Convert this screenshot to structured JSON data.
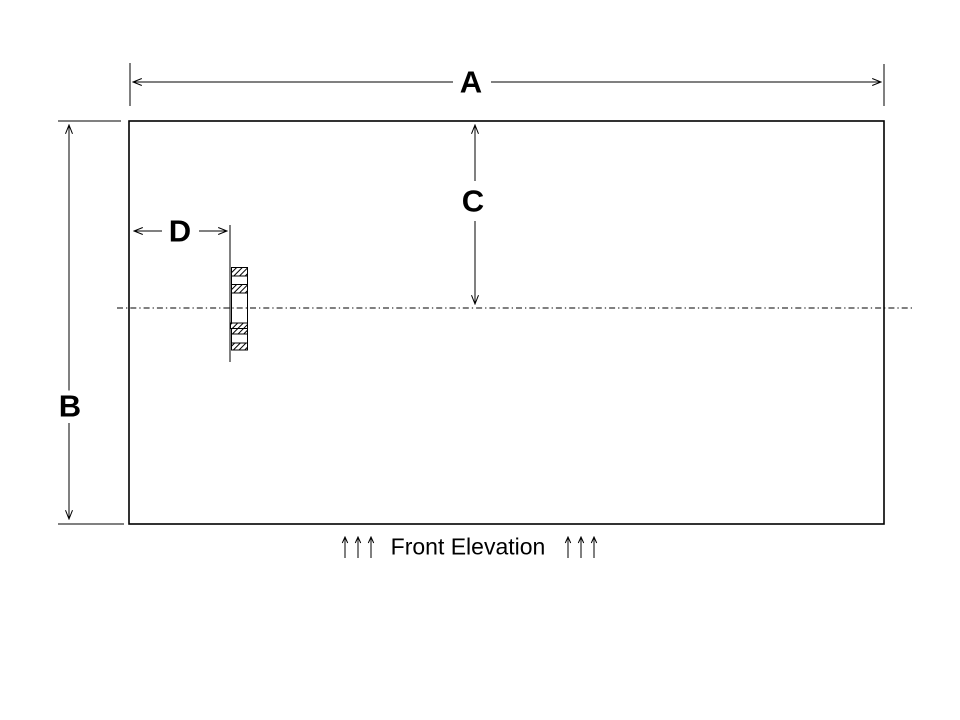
{
  "colors": {
    "ink": "#000000",
    "paper": "#ffffff"
  },
  "drawing": {
    "caption": "Front Elevation",
    "dimensions": {
      "a": "A",
      "b": "B",
      "c": "C",
      "d": "D"
    }
  }
}
